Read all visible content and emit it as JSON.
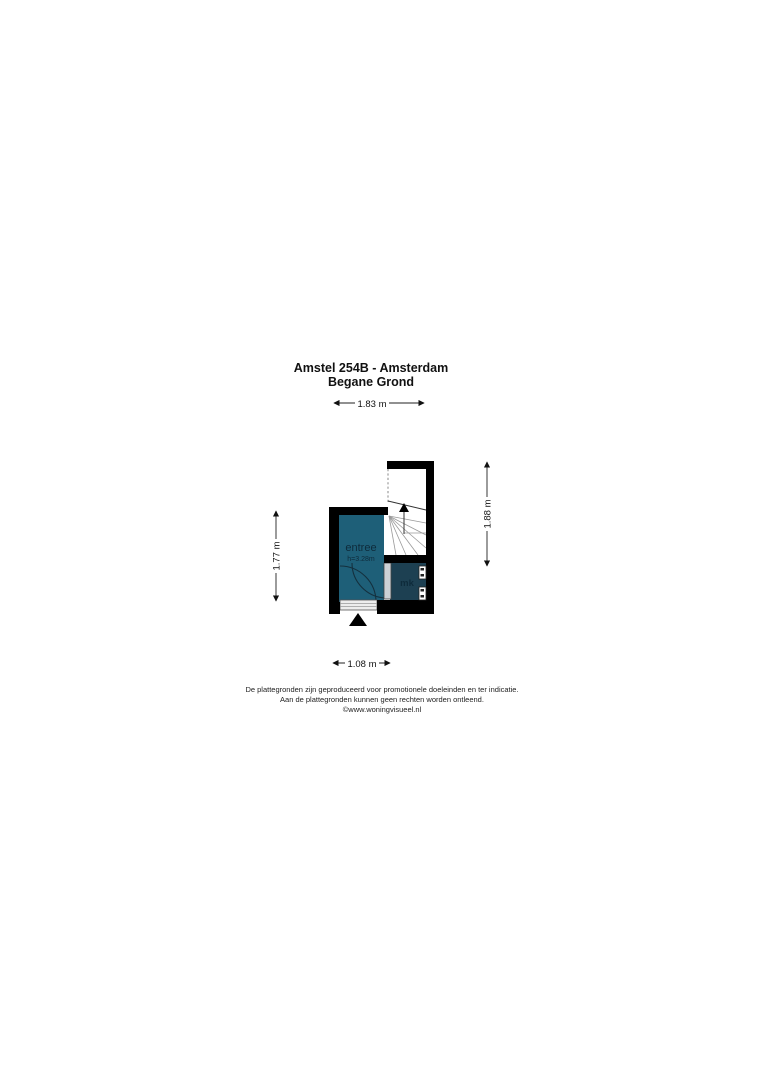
{
  "title": {
    "line1": "Amstel 254B - Amsterdam",
    "line2": "Begane Grond"
  },
  "plan": {
    "dimensions": {
      "top": "1.83 m",
      "bottom": "1.08 m",
      "left": "1.77 m",
      "right": "1.88 m"
    },
    "rooms": {
      "entree": {
        "label": "entree",
        "ceiling_height": "h=3.28m"
      },
      "mk": {
        "label": "mk"
      }
    }
  },
  "colors": {
    "wall": "#000000",
    "entree_fill": "#1e5f78",
    "mk_fill": "#1d4052",
    "room_label": "#0e2b3b",
    "dimension_text": "#111111"
  },
  "footer": {
    "line1": "De plattegronden zijn geproduceerd voor promotionele doeleinden en ter indicatie.",
    "line2": "Aan de plattegronden kunnen geen rechten worden ontleend.",
    "line3": "©www.woningvisueel.nl"
  }
}
